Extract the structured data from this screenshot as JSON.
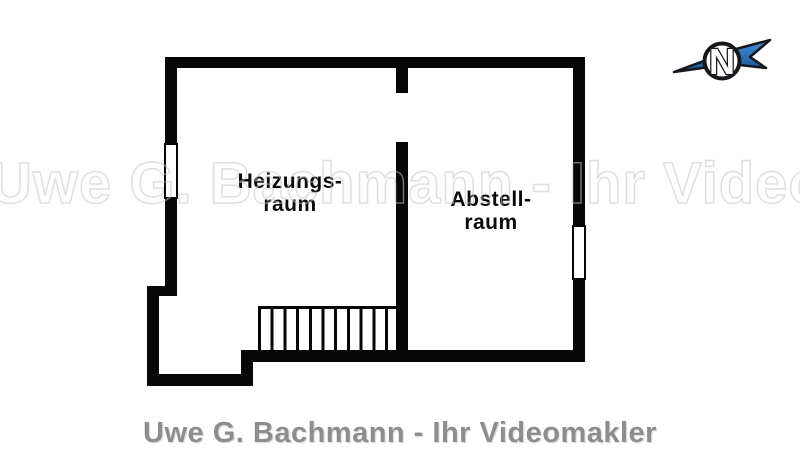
{
  "floor_plan": {
    "rooms": [
      {
        "id": "heizungsraum",
        "label_line1": "Heizungs-",
        "label_line2": "raum"
      },
      {
        "id": "abstellraum",
        "label_line1": "Abstell-",
        "label_line2": "raum"
      }
    ],
    "features": [
      "stairs",
      "door-opening",
      "window-left-wall",
      "window-right-wall"
    ]
  },
  "compass": {
    "north_label": "N"
  },
  "watermark_text": "Uwe G. Bachmann - Ihr Videomakler",
  "footer_text": "Uwe G. Bachmann - Ihr Videomakler",
  "colors": {
    "wall": "#060606",
    "compass_needle": "#2d72b8",
    "compass_needle_dark": "#1c4f8d",
    "footer_text": "#8d8d8d",
    "watermark": "#c6c6c6"
  }
}
